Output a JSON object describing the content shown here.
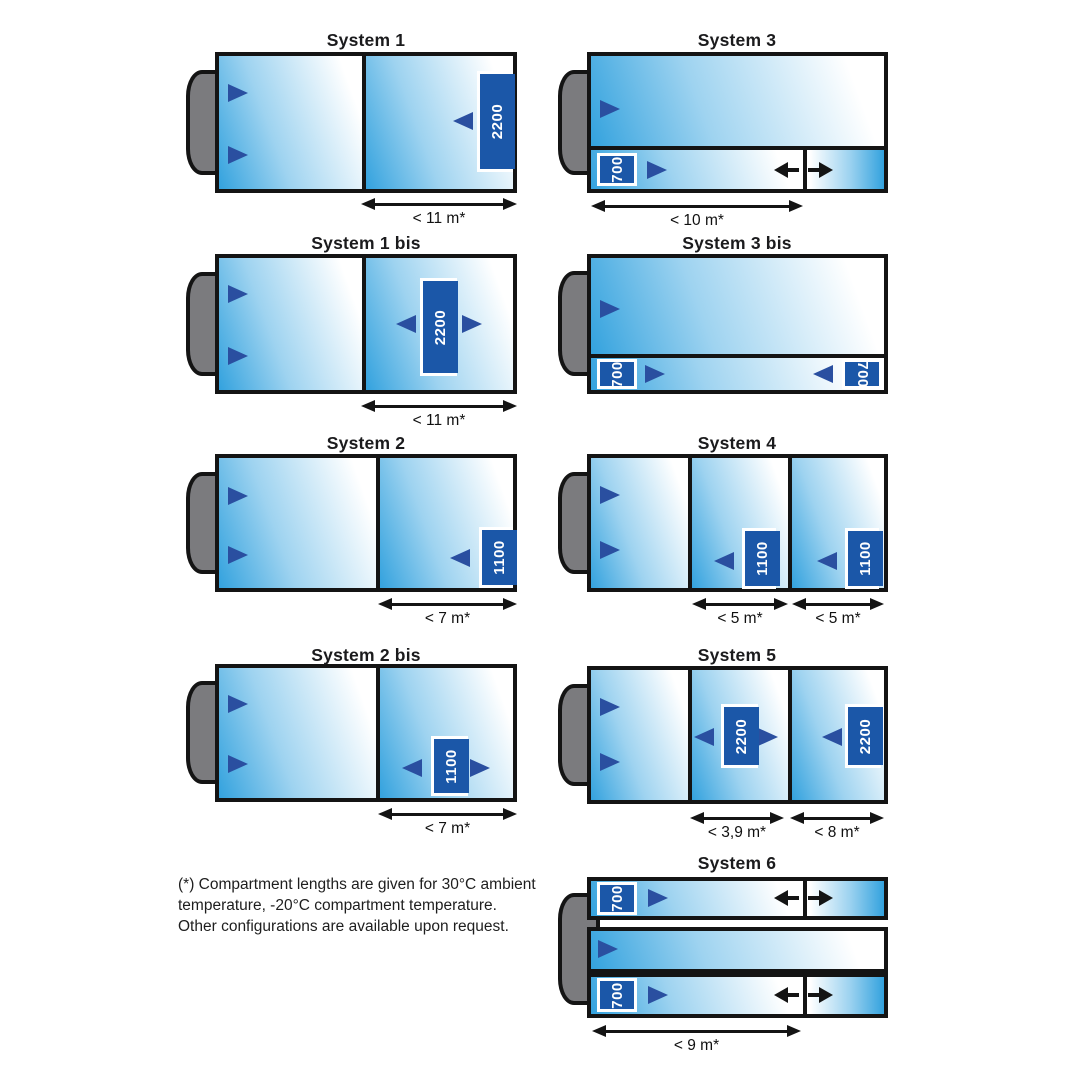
{
  "colors": {
    "trailer_blue": "#33a2de",
    "gradient_mid": "#9ed3f0",
    "fan_navy": "#2a4fa0",
    "tag_blue": "#1b57a8",
    "cab_gray": "#7b7b7e",
    "line_black": "#141414"
  },
  "footnote": {
    "lines": [
      "(*) Compartment lengths are given for 30°C ambient",
      "temperature, -20°C compartment temperature.",
      "Other configurations are available upon request."
    ]
  },
  "systems": [
    {
      "title": "System 1",
      "title_x": 366,
      "title_y": 30,
      "cab": {
        "x": 186,
        "y": 70,
        "w": 42,
        "h": 105
      },
      "bodies": [
        {
          "x": 215,
          "y": 52,
          "w": 302,
          "h": 141
        }
      ],
      "sections": [
        {
          "x": 219,
          "y": 56,
          "w": 143,
          "h": 133,
          "g": "l"
        },
        {
          "x": 366,
          "y": 56,
          "w": 147,
          "h": 133,
          "g": "l"
        }
      ],
      "dividers": [
        {
          "x": 362,
          "y": 56,
          "w": 4,
          "h": 133
        }
      ],
      "fans": [
        {
          "x": 228,
          "y": 84,
          "d": "r"
        },
        {
          "x": 228,
          "y": 146,
          "d": "r"
        },
        {
          "x": 453,
          "y": 112,
          "d": "l"
        }
      ],
      "flows": [],
      "tags": [
        {
          "x": 477,
          "y": 71,
          "w": 36,
          "h": 101,
          "text": "2200",
          "rot": "neg"
        }
      ],
      "dims": [
        {
          "x": 361,
          "y": 197,
          "w": 156,
          "label": "< 11 m*"
        }
      ]
    },
    {
      "title": "System 1 bis",
      "title_x": 366,
      "title_y": 233,
      "cab": {
        "x": 186,
        "y": 272,
        "w": 42,
        "h": 104
      },
      "bodies": [
        {
          "x": 215,
          "y": 254,
          "w": 302,
          "h": 140
        }
      ],
      "sections": [
        {
          "x": 219,
          "y": 258,
          "w": 143,
          "h": 132,
          "g": "l"
        },
        {
          "x": 366,
          "y": 258,
          "w": 147,
          "h": 132,
          "g": "l"
        }
      ],
      "dividers": [
        {
          "x": 362,
          "y": 258,
          "w": 4,
          "h": 132
        }
      ],
      "fans": [
        {
          "x": 228,
          "y": 285,
          "d": "r"
        },
        {
          "x": 228,
          "y": 347,
          "d": "r"
        },
        {
          "x": 396,
          "y": 315,
          "d": "l"
        },
        {
          "x": 462,
          "y": 315,
          "d": "r"
        }
      ],
      "flows": [],
      "tags": [
        {
          "x": 420,
          "y": 278,
          "w": 37,
          "h": 98,
          "text": "2200",
          "rot": "neg"
        }
      ],
      "dims": [
        {
          "x": 361,
          "y": 399,
          "w": 156,
          "label": "< 11 m*"
        }
      ]
    },
    {
      "title": "System 2",
      "title_x": 366,
      "title_y": 433,
      "cab": {
        "x": 186,
        "y": 472,
        "w": 42,
        "h": 102
      },
      "bodies": [
        {
          "x": 215,
          "y": 454,
          "w": 302,
          "h": 138
        }
      ],
      "sections": [
        {
          "x": 219,
          "y": 458,
          "w": 157,
          "h": 130,
          "g": "l"
        },
        {
          "x": 380,
          "y": 458,
          "w": 133,
          "h": 130,
          "g": "l"
        }
      ],
      "dividers": [
        {
          "x": 376,
          "y": 458,
          "w": 4,
          "h": 130
        }
      ],
      "fans": [
        {
          "x": 228,
          "y": 487,
          "d": "r"
        },
        {
          "x": 228,
          "y": 546,
          "d": "r"
        },
        {
          "x": 450,
          "y": 549,
          "d": "l"
        }
      ],
      "flows": [],
      "tags": [
        {
          "x": 479,
          "y": 527,
          "w": 34,
          "h": 61,
          "text": "1100",
          "rot": "neg"
        }
      ],
      "dims": [
        {
          "x": 378,
          "y": 597,
          "w": 139,
          "label": "< 7 m*"
        }
      ]
    },
    {
      "title": "System 2 bis",
      "title_x": 366,
      "title_y": 645,
      "cab": {
        "x": 186,
        "y": 681,
        "w": 42,
        "h": 103
      },
      "bodies": [
        {
          "x": 215,
          "y": 664,
          "w": 302,
          "h": 138
        }
      ],
      "sections": [
        {
          "x": 219,
          "y": 668,
          "w": 157,
          "h": 130,
          "g": "l"
        },
        {
          "x": 380,
          "y": 668,
          "w": 133,
          "h": 130,
          "g": "l"
        }
      ],
      "dividers": [
        {
          "x": 376,
          "y": 668,
          "w": 4,
          "h": 130
        }
      ],
      "fans": [
        {
          "x": 228,
          "y": 695,
          "d": "r"
        },
        {
          "x": 228,
          "y": 755,
          "d": "r"
        },
        {
          "x": 402,
          "y": 759,
          "d": "l"
        },
        {
          "x": 470,
          "y": 759,
          "d": "r"
        }
      ],
      "flows": [],
      "tags": [
        {
          "x": 431,
          "y": 736,
          "w": 37,
          "h": 60,
          "text": "1100",
          "rot": "neg"
        }
      ],
      "dims": [
        {
          "x": 378,
          "y": 807,
          "w": 139,
          "label": "< 7 m*"
        }
      ]
    },
    {
      "title": "System 3",
      "title_x": 737,
      "title_y": 30,
      "cab": {
        "x": 558,
        "y": 70,
        "w": 42,
        "h": 105
      },
      "bodies": [
        {
          "x": 587,
          "y": 52,
          "w": 301,
          "h": 141
        }
      ],
      "sections": [
        {
          "x": 591,
          "y": 56,
          "w": 293,
          "h": 90,
          "g": "l"
        },
        {
          "x": 591,
          "y": 150,
          "w": 212,
          "h": 39,
          "g": "l"
        },
        {
          "x": 807,
          "y": 150,
          "w": 77,
          "h": 39,
          "g": "r"
        }
      ],
      "dividers": [
        {
          "x": 591,
          "y": 146,
          "w": 293,
          "h": 4
        },
        {
          "x": 803,
          "y": 150,
          "w": 4,
          "h": 39
        }
      ],
      "fans": [
        {
          "x": 600,
          "y": 100,
          "d": "r"
        },
        {
          "x": 647,
          "y": 161,
          "d": "r"
        }
      ],
      "flows": [
        {
          "x": 774,
          "y": 162,
          "d": "l"
        },
        {
          "x": 808,
          "y": 162,
          "d": "r"
        }
      ],
      "tags": [
        {
          "x": 597,
          "y": 153,
          "w": 40,
          "h": 33,
          "text": "700",
          "rot": "neg"
        }
      ],
      "dims": [
        {
          "x": 591,
          "y": 199,
          "w": 212,
          "label": "< 10 m*"
        }
      ]
    },
    {
      "title": "System 3 bis",
      "title_x": 737,
      "title_y": 233,
      "cab": {
        "x": 558,
        "y": 271,
        "w": 42,
        "h": 105
      },
      "bodies": [
        {
          "x": 587,
          "y": 254,
          "w": 301,
          "h": 140
        }
      ],
      "sections": [
        {
          "x": 591,
          "y": 258,
          "w": 293,
          "h": 96,
          "g": "l"
        },
        {
          "x": 591,
          "y": 358,
          "w": 293,
          "h": 32,
          "g": "l"
        }
      ],
      "dividers": [
        {
          "x": 591,
          "y": 354,
          "w": 293,
          "h": 4
        }
      ],
      "fans": [
        {
          "x": 600,
          "y": 300,
          "d": "r"
        },
        {
          "x": 645,
          "y": 365,
          "d": "r"
        },
        {
          "x": 813,
          "y": 365,
          "d": "l"
        }
      ],
      "flows": [],
      "tags": [
        {
          "x": 597,
          "y": 359,
          "w": 40,
          "h": 30,
          "text": "700",
          "rot": "neg"
        },
        {
          "x": 842,
          "y": 359,
          "w": 40,
          "h": 30,
          "text": "700",
          "rot": "pos"
        }
      ],
      "dims": []
    },
    {
      "title": "System 4",
      "title_x": 737,
      "title_y": 433,
      "cab": {
        "x": 558,
        "y": 472,
        "w": 42,
        "h": 102
      },
      "bodies": [
        {
          "x": 587,
          "y": 454,
          "w": 301,
          "h": 138
        }
      ],
      "sections": [
        {
          "x": 591,
          "y": 458,
          "w": 97,
          "h": 130,
          "g": "l"
        },
        {
          "x": 692,
          "y": 458,
          "w": 96,
          "h": 130,
          "g": "l"
        },
        {
          "x": 792,
          "y": 458,
          "w": 92,
          "h": 130,
          "g": "l"
        }
      ],
      "dividers": [
        {
          "x": 688,
          "y": 458,
          "w": 4,
          "h": 130
        },
        {
          "x": 788,
          "y": 458,
          "w": 4,
          "h": 130
        }
      ],
      "fans": [
        {
          "x": 600,
          "y": 486,
          "d": "r"
        },
        {
          "x": 600,
          "y": 541,
          "d": "r"
        },
        {
          "x": 714,
          "y": 552,
          "d": "l"
        },
        {
          "x": 817,
          "y": 552,
          "d": "l"
        }
      ],
      "flows": [],
      "tags": [
        {
          "x": 742,
          "y": 528,
          "w": 34,
          "h": 61,
          "text": "1100",
          "rot": "neg"
        },
        {
          "x": 845,
          "y": 528,
          "w": 34,
          "h": 61,
          "text": "1100",
          "rot": "neg"
        }
      ],
      "dims": [
        {
          "x": 692,
          "y": 597,
          "w": 96,
          "label": "< 5 m*"
        },
        {
          "x": 792,
          "y": 597,
          "w": 92,
          "label": "< 5 m*"
        }
      ]
    },
    {
      "title": "System 5",
      "title_x": 737,
      "title_y": 645,
      "cab": {
        "x": 558,
        "y": 684,
        "w": 42,
        "h": 102
      },
      "bodies": [
        {
          "x": 587,
          "y": 666,
          "w": 301,
          "h": 138
        }
      ],
      "sections": [
        {
          "x": 591,
          "y": 670,
          "w": 97,
          "h": 130,
          "g": "l"
        },
        {
          "x": 692,
          "y": 670,
          "w": 96,
          "h": 130,
          "g": "l"
        },
        {
          "x": 792,
          "y": 670,
          "w": 92,
          "h": 130,
          "g": "l"
        }
      ],
      "dividers": [
        {
          "x": 688,
          "y": 670,
          "w": 4,
          "h": 130
        },
        {
          "x": 788,
          "y": 670,
          "w": 4,
          "h": 130
        }
      ],
      "fans": [
        {
          "x": 600,
          "y": 698,
          "d": "r"
        },
        {
          "x": 600,
          "y": 753,
          "d": "r"
        },
        {
          "x": 694,
          "y": 728,
          "d": "l"
        },
        {
          "x": 758,
          "y": 728,
          "d": "r"
        },
        {
          "x": 822,
          "y": 728,
          "d": "l"
        }
      ],
      "flows": [],
      "tags": [
        {
          "x": 721,
          "y": 704,
          "w": 37,
          "h": 64,
          "text": "2200",
          "rot": "neg"
        },
        {
          "x": 845,
          "y": 704,
          "w": 36,
          "h": 64,
          "text": "2200",
          "rot": "neg"
        }
      ],
      "dims": [
        {
          "x": 690,
          "y": 811,
          "w": 94,
          "label": "< 3,9 m*"
        },
        {
          "x": 790,
          "y": 811,
          "w": 94,
          "label": "< 8 m*"
        }
      ]
    },
    {
      "title": "System 6",
      "title_x": 737,
      "title_y": 853,
      "cab": {
        "x": 558,
        "y": 893,
        "w": 42,
        "h": 112
      },
      "bodies": [
        {
          "x": 587,
          "y": 877,
          "w": 301,
          "h": 43
        },
        {
          "x": 587,
          "y": 927,
          "w": 301,
          "h": 46
        },
        {
          "x": 587,
          "y": 973,
          "w": 301,
          "h": 45
        }
      ],
      "sections": [
        {
          "x": 591,
          "y": 881,
          "w": 212,
          "h": 35,
          "g": "l"
        },
        {
          "x": 807,
          "y": 881,
          "w": 77,
          "h": 35,
          "g": "r"
        },
        {
          "x": 591,
          "y": 931,
          "w": 293,
          "h": 38,
          "g": "l"
        },
        {
          "x": 591,
          "y": 977,
          "w": 212,
          "h": 37,
          "g": "l"
        },
        {
          "x": 807,
          "y": 977,
          "w": 77,
          "h": 37,
          "g": "r"
        }
      ],
      "dividers": [
        {
          "x": 803,
          "y": 881,
          "w": 4,
          "h": 35
        },
        {
          "x": 803,
          "y": 977,
          "w": 4,
          "h": 37
        }
      ],
      "fans": [
        {
          "x": 648,
          "y": 889,
          "d": "r"
        },
        {
          "x": 598,
          "y": 940,
          "d": "r"
        },
        {
          "x": 648,
          "y": 986,
          "d": "r"
        }
      ],
      "flows": [
        {
          "x": 774,
          "y": 890,
          "d": "l"
        },
        {
          "x": 808,
          "y": 890,
          "d": "r"
        },
        {
          "x": 774,
          "y": 987,
          "d": "l"
        },
        {
          "x": 808,
          "y": 987,
          "d": "r"
        }
      ],
      "tags": [
        {
          "x": 597,
          "y": 882,
          "w": 40,
          "h": 33,
          "text": "700",
          "rot": "neg"
        },
        {
          "x": 597,
          "y": 978,
          "w": 40,
          "h": 34,
          "text": "700",
          "rot": "neg"
        }
      ],
      "dims": [
        {
          "x": 592,
          "y": 1024,
          "w": 209,
          "label": "< 9 m*"
        }
      ]
    }
  ]
}
